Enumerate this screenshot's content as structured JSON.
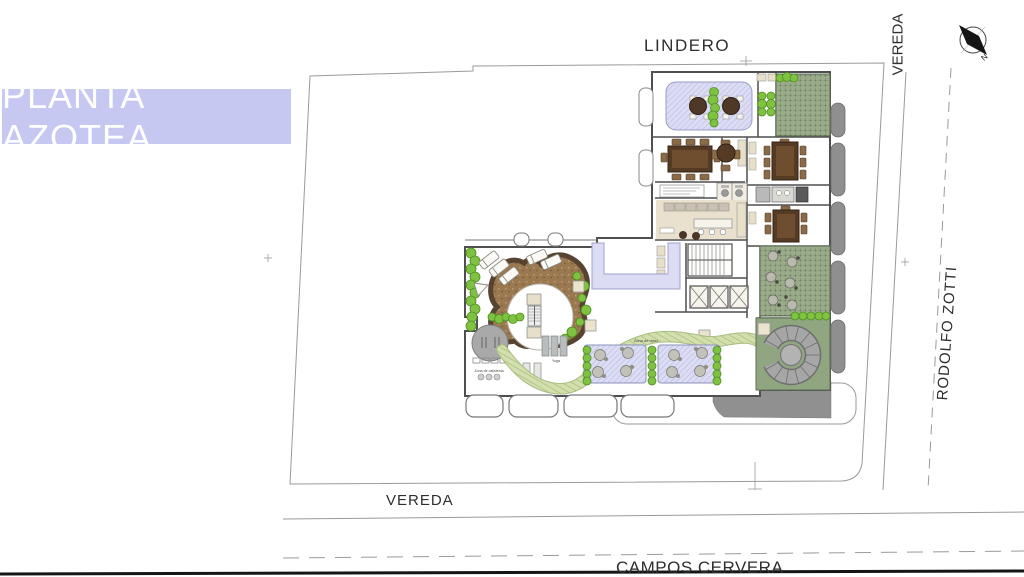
{
  "title_band": {
    "label": "PLANTA AZOTEA"
  },
  "streets": {
    "lindero": "LINDERO",
    "vereda_top": "VEREDA",
    "rodolfo_zotti": "RODOLFO ZOTTI",
    "vereda_bottom": "VEREDA",
    "campos_cervera": "CAMPOS CERVERA"
  },
  "compass": {
    "north_label": "N"
  },
  "plan_labels": {
    "calistenia": "Zona de calistenia",
    "yoga": "Yoga",
    "relax": "Zona de relax"
  },
  "colors": {
    "band_bg": "#c7c8f2",
    "band_text": "#ffffff",
    "walkway_lavender": "#dcdcf4",
    "green_roof": "#9aab8a",
    "bush_green": "#7fc241",
    "path_green": "#d3dfae",
    "deck_brown": "#9a7850",
    "room_beige": "#e9e0cd",
    "table_brown": "#553b24",
    "balcony_gray": "#8f8f8f",
    "boundary_line": "#9a9a9a"
  }
}
